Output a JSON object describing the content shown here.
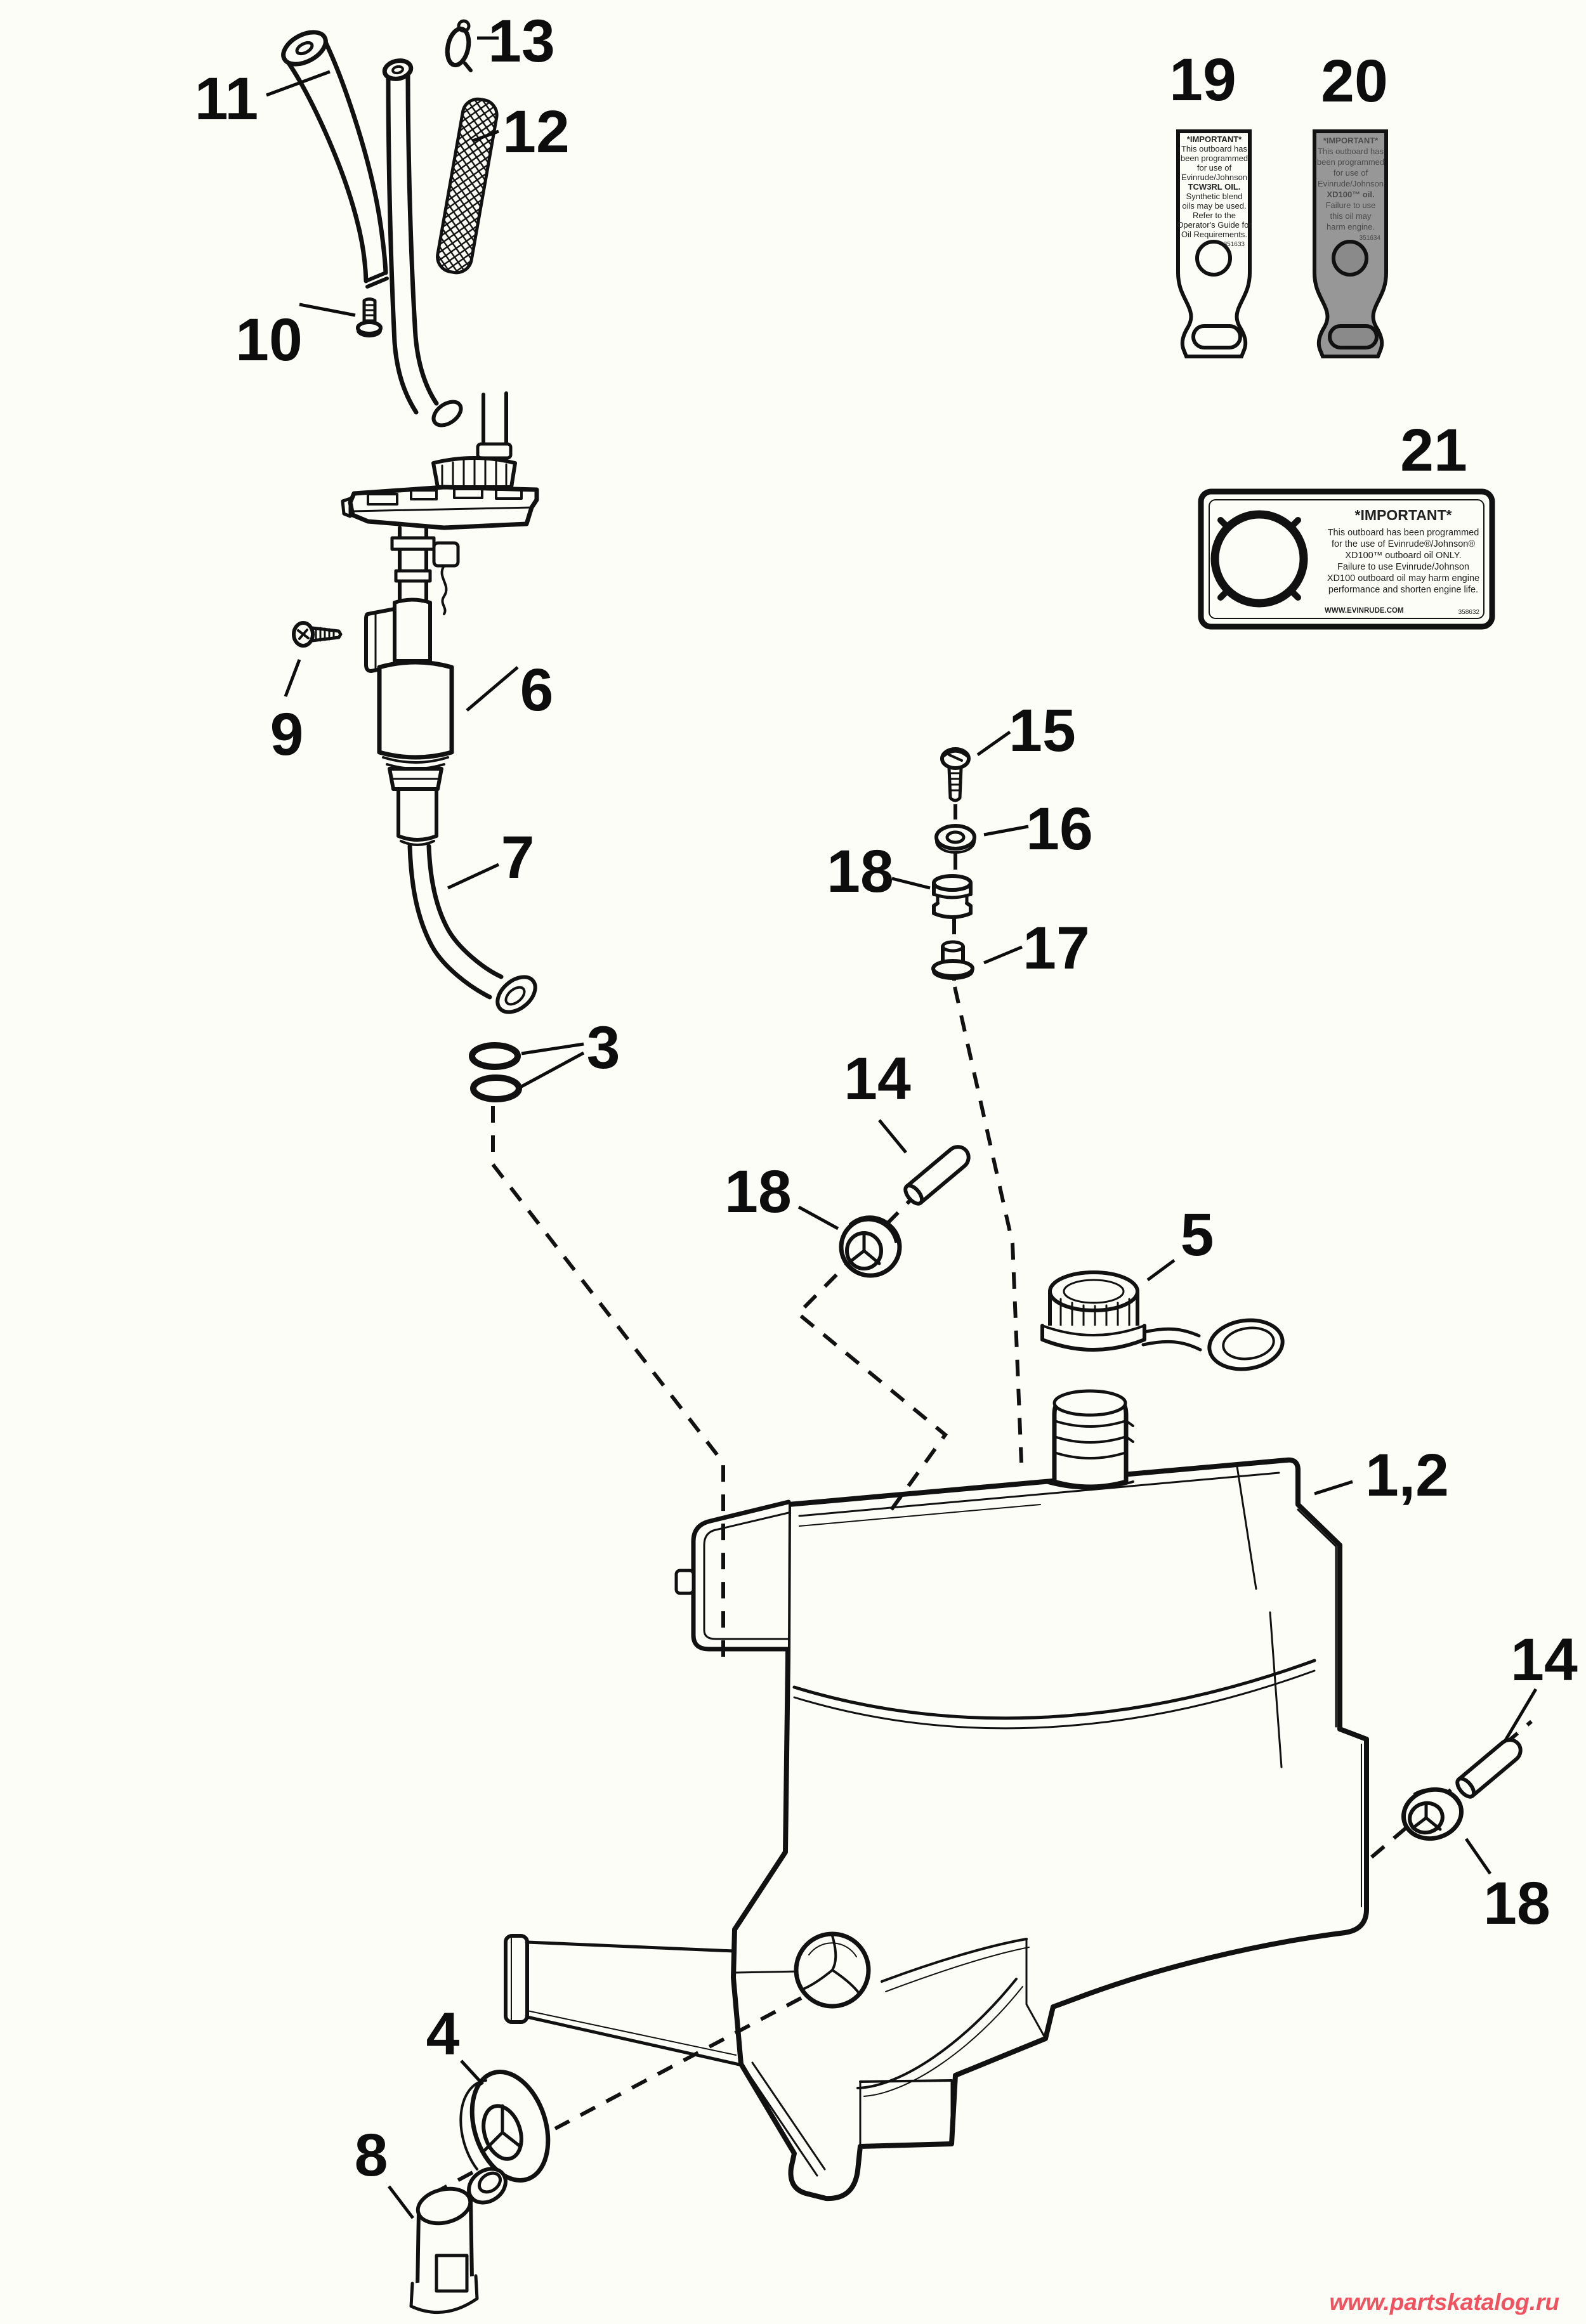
{
  "watermark": {
    "text": "www.partskatalog.ru",
    "color": "#f0525f"
  },
  "colors": {
    "line": "#111111",
    "background": "#fdfdf8",
    "tag20_fill": "#979797"
  },
  "callouts": [
    {
      "id": "13",
      "text": "13"
    },
    {
      "id": "11",
      "text": "11"
    },
    {
      "id": "12",
      "text": "12"
    },
    {
      "id": "10",
      "text": "10"
    },
    {
      "id": "9",
      "text": "9"
    },
    {
      "id": "6",
      "text": "6"
    },
    {
      "id": "7",
      "text": "7"
    },
    {
      "id": "3",
      "text": "3"
    },
    {
      "id": "15",
      "text": "15"
    },
    {
      "id": "16",
      "text": "16"
    },
    {
      "id": "18m",
      "text": "18"
    },
    {
      "id": "17",
      "text": "17"
    },
    {
      "id": "14l",
      "text": "14"
    },
    {
      "id": "18l",
      "text": "18"
    },
    {
      "id": "5",
      "text": "5"
    },
    {
      "id": "1-2",
      "text": "1,2"
    },
    {
      "id": "14r",
      "text": "14"
    },
    {
      "id": "18r",
      "text": "18"
    },
    {
      "id": "4",
      "text": "4"
    },
    {
      "id": "8",
      "text": "8"
    },
    {
      "id": "19",
      "text": "19"
    },
    {
      "id": "20",
      "text": "20"
    },
    {
      "id": "21",
      "text": "21"
    }
  ],
  "tags": {
    "t19": {
      "lines": [
        "*IMPORTANT*",
        "This outboard has",
        "been programmed",
        "for use of",
        "Evinrude/Johnson",
        "TCW3RL OIL.",
        "Synthetic blend",
        "oils may be used.",
        "Refer to the",
        "Operator's Guide for",
        "Oil Requirements."
      ],
      "code": "351633"
    },
    "t20": {
      "lines": [
        "*IMPORTANT*",
        "This outboard has",
        "been programmed",
        "for use of",
        "Evinrude/Johnson",
        "XD100™ oil.",
        "Failure to use",
        "this oil may",
        "harm engine."
      ],
      "code": "351634"
    },
    "t21": {
      "title": "*IMPORTANT*",
      "lines": [
        "This outboard has been programmed",
        "for the use of Evinrude®/Johnson®",
        "XD100™ outboard oil ONLY.",
        "Failure to use Evinrude/Johnson",
        "XD100 outboard oil may harm engine",
        "performance and shorten engine life."
      ],
      "footer_left": "WWW.EVINRUDE.COM",
      "footer_right": "358632"
    }
  }
}
